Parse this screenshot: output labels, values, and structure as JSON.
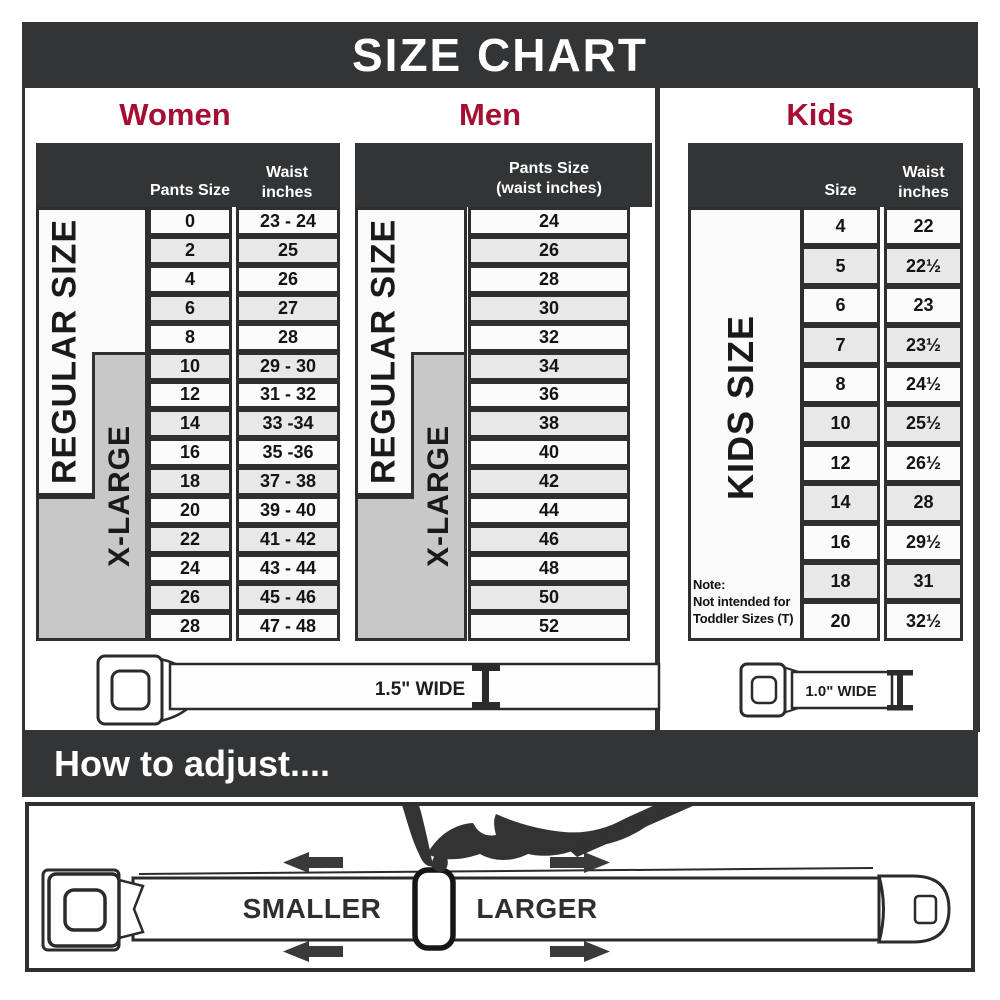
{
  "title": "SIZE CHART",
  "colors": {
    "accent": "#A50F33",
    "bar": "#323436",
    "row_alt": "#E8E8E8",
    "xlarge_gray": "#C8C8C8"
  },
  "sections": {
    "women": {
      "label": "Women",
      "col1": "Pants Size",
      "col2_line1": "Waist",
      "col2_line2": "inches",
      "regular_label": "REGULAR SIZE",
      "xlarge_label": "X-LARGE",
      "rows": [
        [
          "0",
          "23 - 24"
        ],
        [
          "2",
          "25"
        ],
        [
          "4",
          "26"
        ],
        [
          "6",
          "27"
        ],
        [
          "8",
          "28"
        ],
        [
          "10",
          "29 - 30"
        ],
        [
          "12",
          "31 - 32"
        ],
        [
          "14",
          "33 -34"
        ],
        [
          "16",
          "35 -36"
        ],
        [
          "18",
          "37 - 38"
        ],
        [
          "20",
          "39 - 40"
        ],
        [
          "22",
          "41 - 42"
        ],
        [
          "24",
          "43 - 44"
        ],
        [
          "26",
          "45 - 46"
        ],
        [
          "28",
          "47 - 48"
        ]
      ]
    },
    "men": {
      "label": "Men",
      "col_line1": "Pants Size",
      "col_line2": "(waist inches)",
      "regular_label": "REGULAR SIZE",
      "xlarge_label": "X-LARGE",
      "rows": [
        "24",
        "26",
        "28",
        "30",
        "32",
        "34",
        "36",
        "38",
        "40",
        "42",
        "44",
        "46",
        "48",
        "50",
        "52"
      ]
    },
    "kids": {
      "label": "Kids",
      "col1": "Size",
      "col2_line1": "Waist",
      "col2_line2": "inches",
      "side_label": "KIDS SIZE",
      "note_line1": "Note:",
      "note_line2": "Not intended for",
      "note_line3": "Toddler Sizes (T)",
      "rows": [
        [
          "4",
          "22"
        ],
        [
          "5",
          "22½"
        ],
        [
          "6",
          "23"
        ],
        [
          "7",
          "23½"
        ],
        [
          "8",
          "24½"
        ],
        [
          "10",
          "25½"
        ],
        [
          "12",
          "26½"
        ],
        [
          "14",
          "28"
        ],
        [
          "16",
          "29½"
        ],
        [
          "18",
          "31"
        ],
        [
          "20",
          "32½"
        ]
      ]
    }
  },
  "belts": {
    "adult_width_label": "1.5\" WIDE",
    "kids_width_label": "1.0\" WIDE"
  },
  "adjust": {
    "heading": "How to adjust....",
    "smaller": "SMALLER",
    "larger": "LARGER"
  }
}
